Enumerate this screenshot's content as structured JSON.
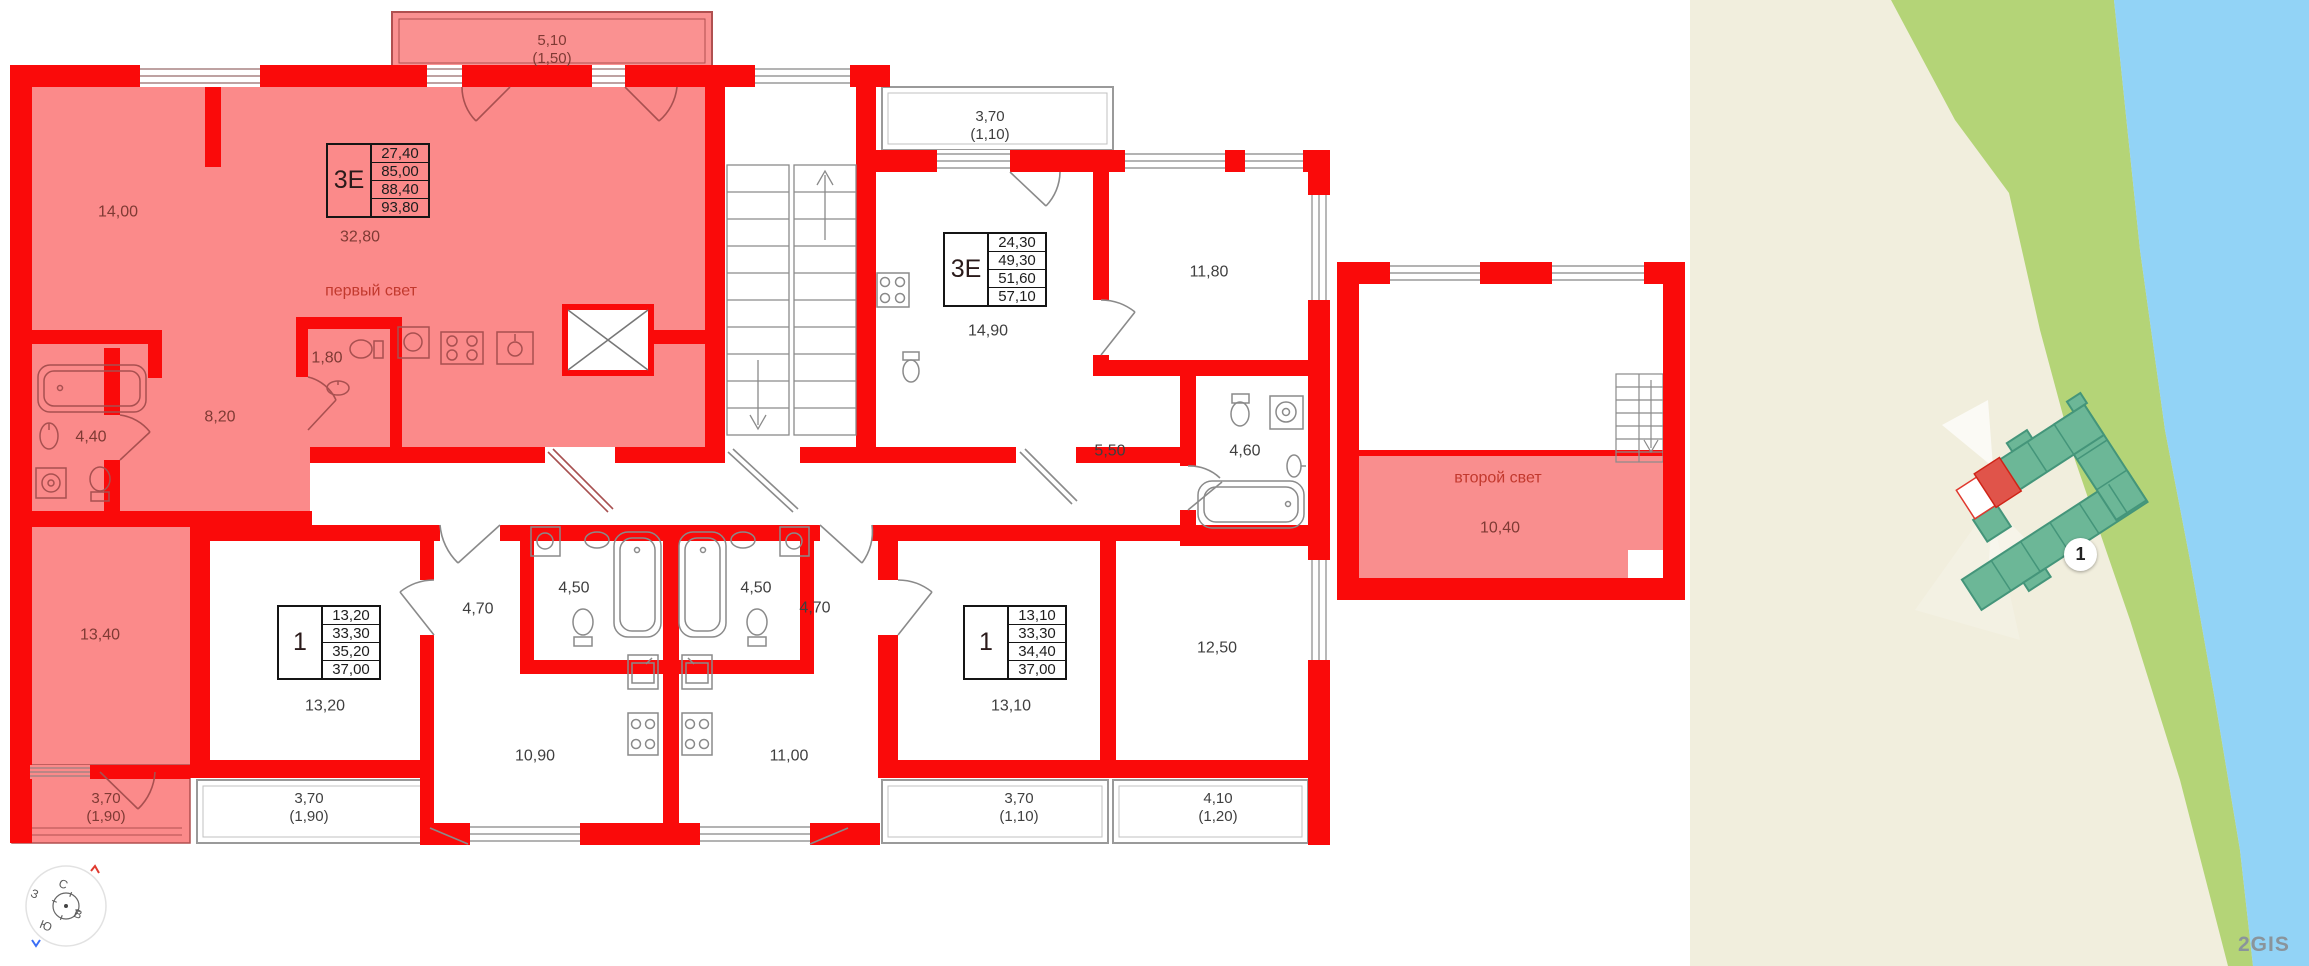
{
  "plan": {
    "balconies": {
      "top": {
        "a": "5,10",
        "b": "(1,50)"
      },
      "bottom_left_inner": {
        "a": "3,70",
        "b": "(1,90)"
      },
      "bottom_left_outer": {
        "a": "3,70",
        "b": "(1,90)"
      },
      "top_right": {
        "a": "3,70",
        "b": "(1,10)"
      },
      "bottom_right_inner": {
        "a": "3,70",
        "b": "(1,10)"
      },
      "bottom_right_outer": {
        "a": "4,10",
        "b": "(1,20)"
      }
    },
    "tables": [
      {
        "type": "3Е",
        "v1": "27,40",
        "v2": "85,00",
        "v3": "88,40",
        "v4": "93,80"
      },
      {
        "type": "3Е",
        "v1": "24,30",
        "v2": "49,30",
        "v3": "51,60",
        "v4": "57,10"
      },
      {
        "type": "1",
        "v1": "13,20",
        "v2": "33,30",
        "v3": "35,20",
        "v4": "37,00"
      },
      {
        "type": "1",
        "v1": "13,10",
        "v2": "33,30",
        "v3": "34,40",
        "v4": "37,00"
      }
    ],
    "rooms": {
      "living_14_00": "14,00",
      "living_32_80": "32,80",
      "first_light": "первый свет",
      "wc_1_80": "1,80",
      "hall_8_20": "8,20",
      "bath_4_40": "4,40",
      "bedroom_13_40": "13,40",
      "room_14_90": "14,90",
      "room_11_80": "11,80",
      "hall_5_50": "5,50",
      "bath_4_60": "4,60",
      "room_12_50": "12,50",
      "hall_4_70_left": "4,70",
      "bath_4_50_left": "4,50",
      "bath_4_50_right": "4,50",
      "hall_4_70_right": "4,70",
      "room_13_20": "13,20",
      "kitchen_10_90": "10,90",
      "kitchen_11_00": "11,00",
      "room_13_10": "13,10",
      "second_light": "второй свет",
      "room_10_40": "10,40"
    },
    "compass": {
      "north": "С",
      "east": "В",
      "south": "Ю",
      "west": "З"
    }
  },
  "map": {
    "building_badge": "1",
    "watermark": "2GIS"
  },
  "colors": {
    "wall_red": "#fa0a0a",
    "highlight_pink": "#fb8a8a",
    "accent_red_text": "#c2392e",
    "map_land": "#f1eedd",
    "map_green": "#b4d477",
    "map_water": "#92d3f6",
    "building_fill": "#6cb797",
    "building_stroke": "#44957a",
    "building_highlight": "#e0544a"
  }
}
